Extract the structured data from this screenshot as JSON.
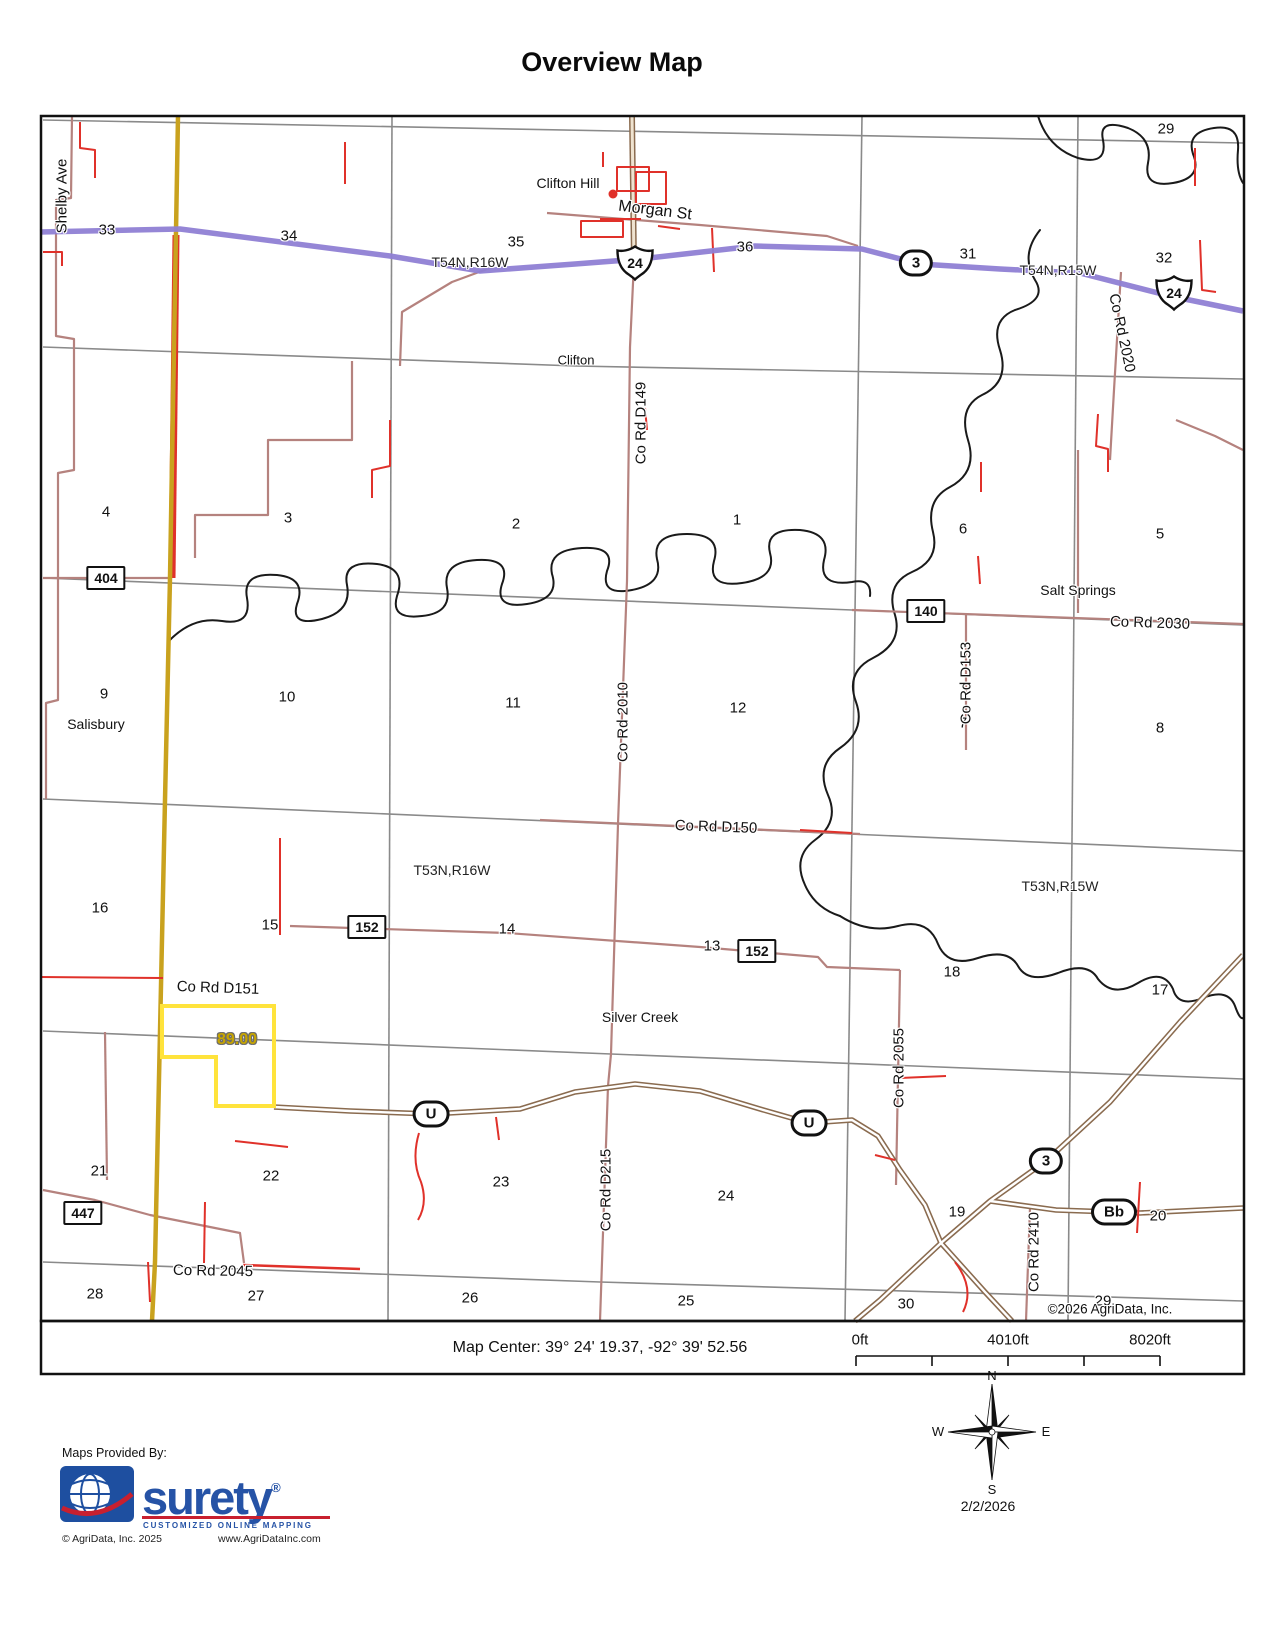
{
  "title": "Overview Map",
  "map": {
    "copyright": "©2026 AgriData, Inc.",
    "parcel_acres": "89.00",
    "sections": [
      "33",
      "34",
      "35",
      "36",
      "31",
      "32",
      "29",
      "4",
      "3",
      "2",
      "1",
      "6",
      "5",
      "9",
      "10",
      "11",
      "12",
      "7",
      "8",
      "16",
      "15",
      "14",
      "13",
      "18",
      "17",
      "21",
      "22",
      "23",
      "24",
      "19",
      "20",
      "28",
      "27",
      "26",
      "25",
      "30",
      "29"
    ],
    "townships": [
      "T54N,R16W",
      "T54N,R15W",
      "T53N,R16W",
      "T53N,R15W"
    ],
    "places": [
      "Clifton Hill",
      "Clifton",
      "Salisbury",
      "Salt Springs",
      "Silver Creek"
    ],
    "roads": [
      "Shelby Ave",
      "Morgan St",
      "Co Rd D149",
      "Co Rd 2020",
      "Co Rd 2030",
      "Co Rd D153",
      "Co Rd 2010",
      "Co Rd D150",
      "Co Rd D151",
      "Co Rd 2055",
      "Co Rd D215",
      "Co Rd 2410",
      "Co Rd 2045"
    ],
    "shields": {
      "us": [
        "24",
        "24"
      ],
      "state": [
        "3",
        "U",
        "U",
        "3",
        "Bb"
      ],
      "county": [
        "404",
        "140",
        "152",
        "152",
        "447"
      ]
    }
  },
  "footer": {
    "map_center": "Map Center: 39° 24' 19.37,  -92° 39' 52.56",
    "scale": [
      "0ft",
      "4010ft",
      "8020ft"
    ]
  },
  "compass": {
    "n": "N",
    "e": "E",
    "s": "S",
    "w": "W",
    "date": "2/2/2026"
  },
  "branding": {
    "provided_by": "Maps Provided By:",
    "logo": "surety",
    "registered": "®",
    "tagline": "CUSTOMIZED ONLINE MAPPING",
    "copyright": "© AgriData, Inc. 2025",
    "website": "www.AgriDataInc.com"
  },
  "colors": {
    "highway_purple": "#8F7FD4",
    "road_rosy": "#B5827E",
    "road_yellow": "#C9A21E",
    "parcel_yellow": "#FFE33B",
    "feature_red": "#E0312A",
    "grid_gray": "#8A8A8A",
    "creek_black": "#1A1A1A",
    "brand_blue": "#2653A6",
    "brand_red": "#C8202F"
  }
}
